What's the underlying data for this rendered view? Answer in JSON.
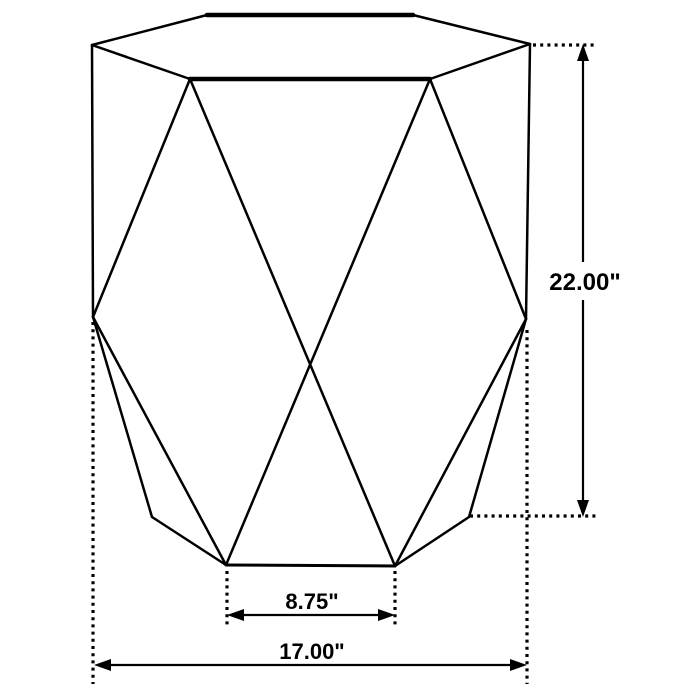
{
  "figure": {
    "kind": "furniture-dimension-line-drawing",
    "dimension_labels": {
      "height": "22.00\"",
      "base_front_width": "8.75\"",
      "overall_width": "17.00\""
    },
    "colors": {
      "line": "#000000",
      "background": "#ffffff"
    }
  }
}
